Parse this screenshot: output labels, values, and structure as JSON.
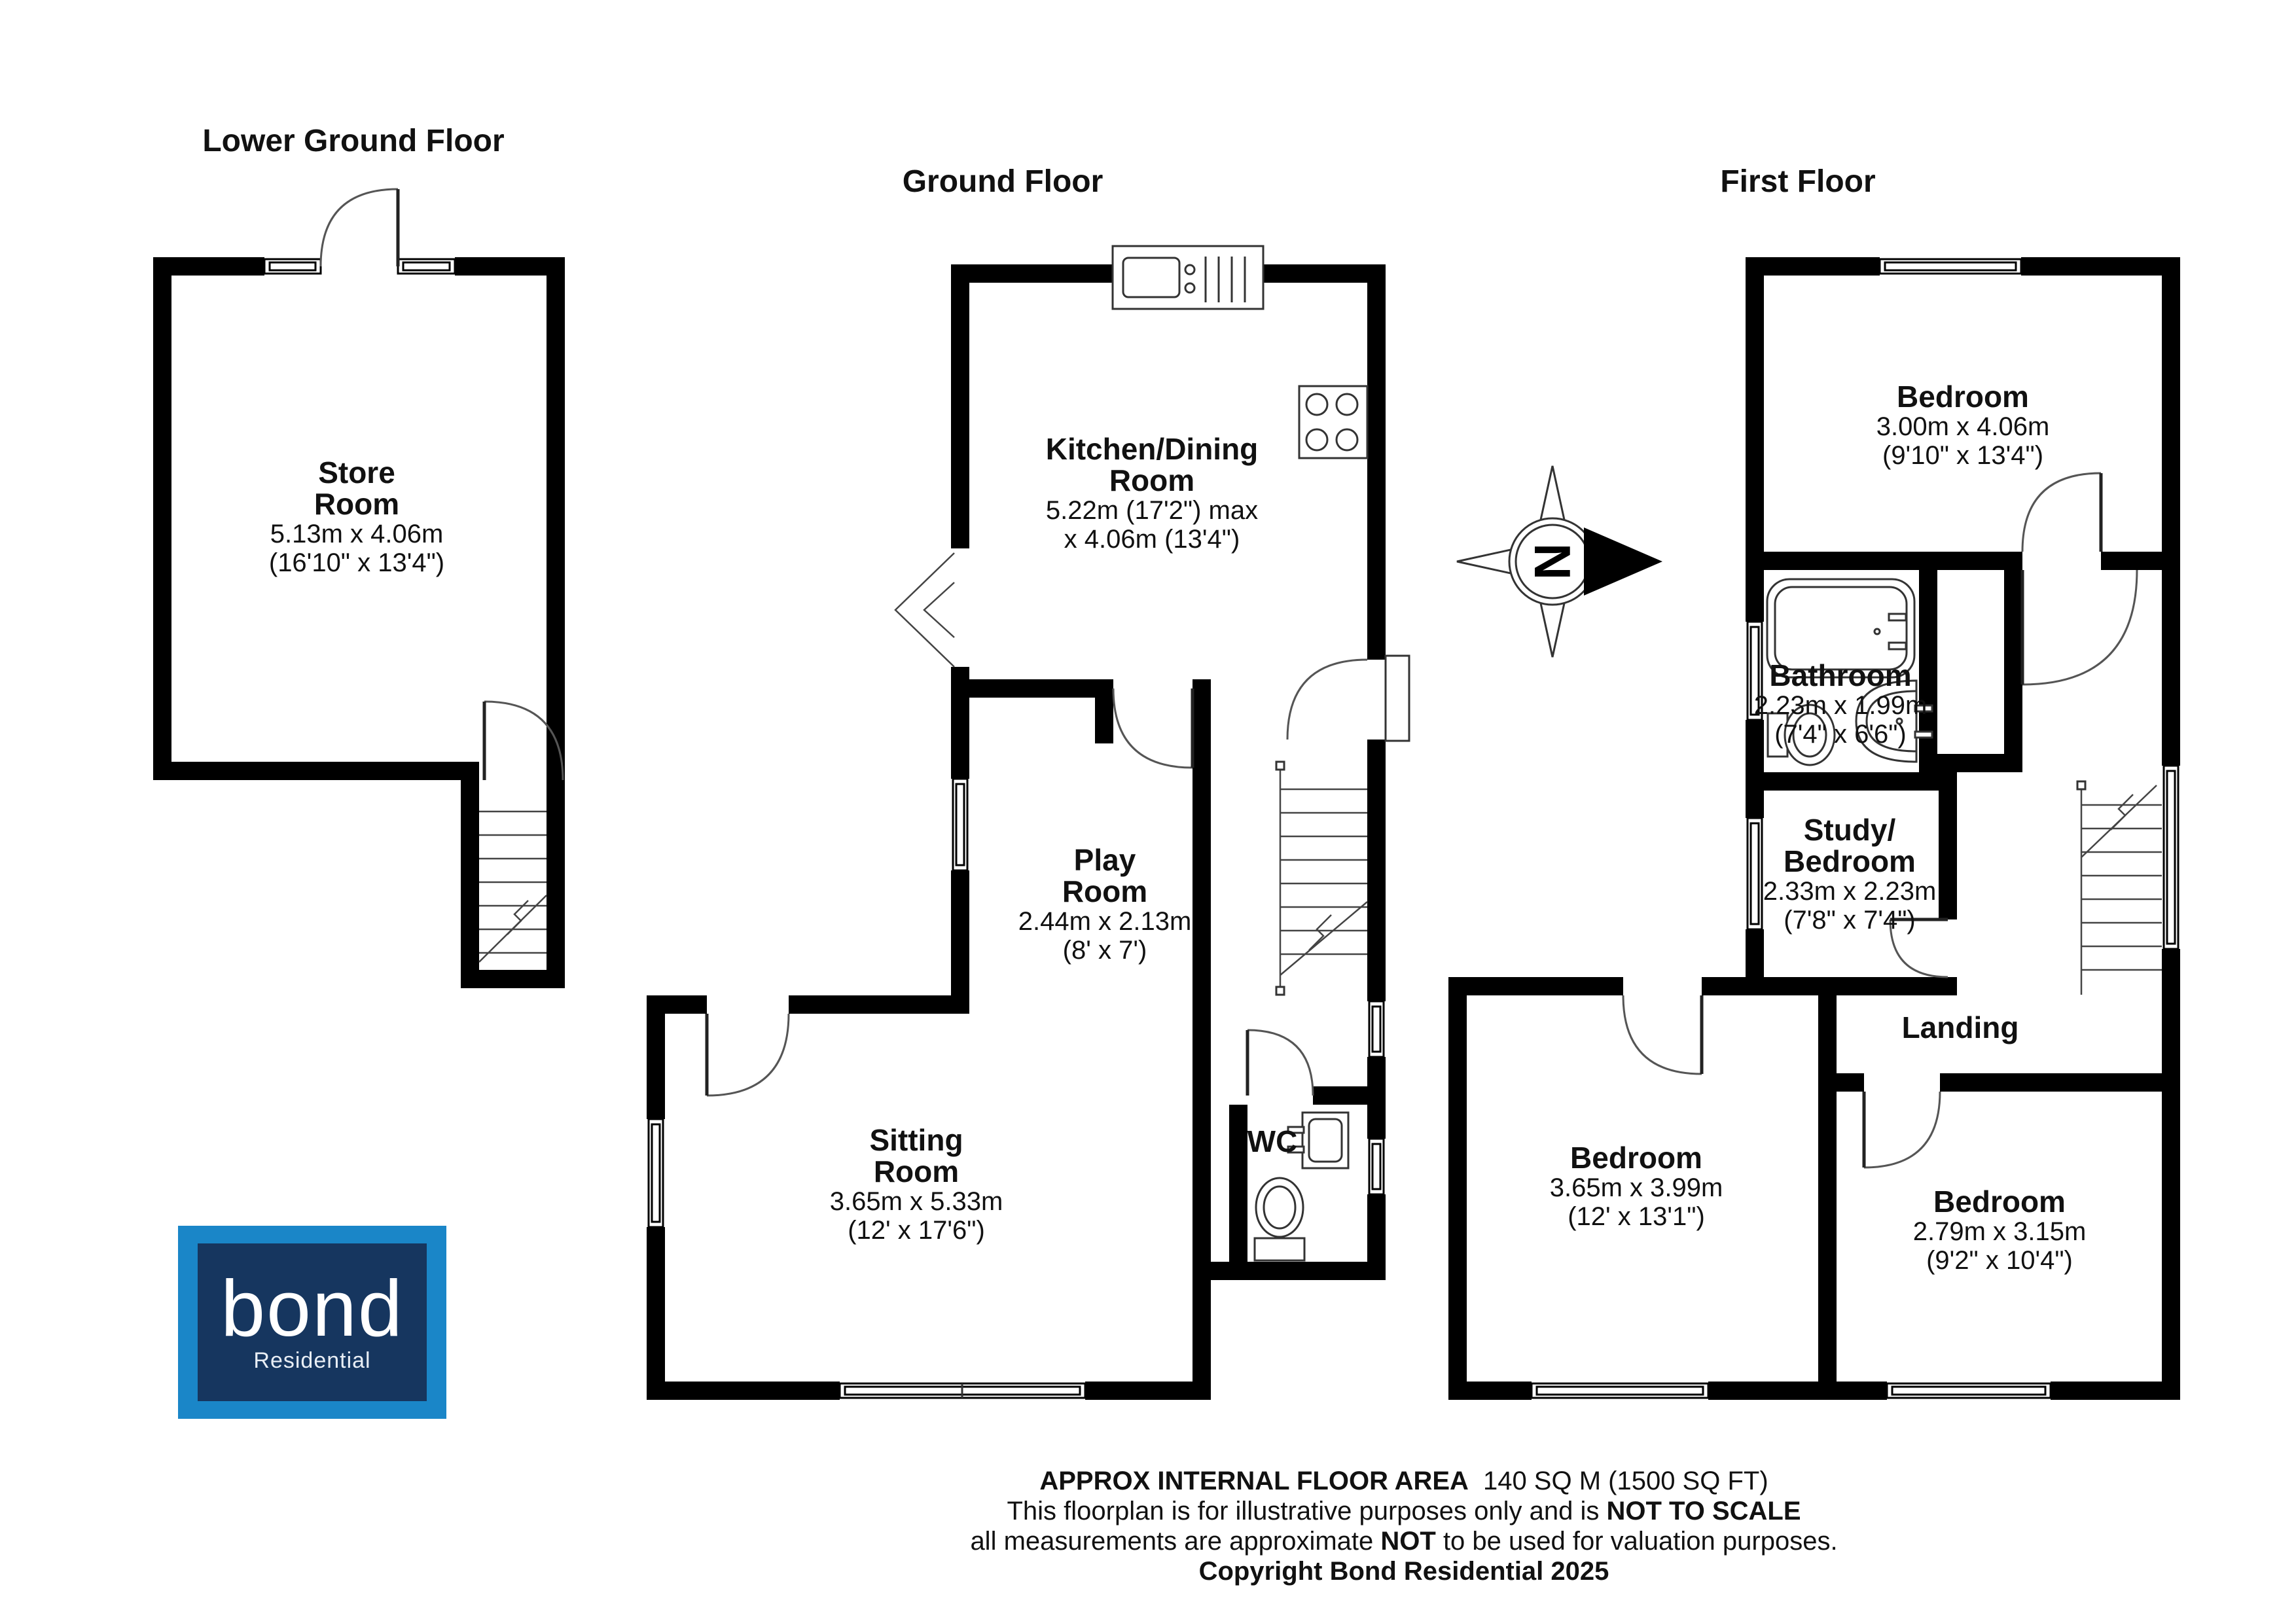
{
  "titles": {
    "lower": "Lower Ground Floor",
    "ground": "Ground Floor",
    "first": "First Floor"
  },
  "compass": {
    "letter": "N"
  },
  "rooms": {
    "store": {
      "line1": "Store",
      "line2": "Room",
      "dims1": "5.13m x 4.06m",
      "dims2": "(16'10\" x 13'4\")"
    },
    "kitchen": {
      "line1": "Kitchen/Dining",
      "line2": "Room",
      "dims1": "5.22m (17'2\") max",
      "dims2": "x 4.06m (13'4\")"
    },
    "play": {
      "line1": "Play",
      "line2": "Room",
      "dims1": "2.44m x 2.13m",
      "dims2": "(8' x 7')"
    },
    "sitting": {
      "line1": "Sitting",
      "line2": "Room",
      "dims1": "3.65m x 5.33m",
      "dims2": "(12' x 17'6\")"
    },
    "wc": {
      "line1": "WC"
    },
    "bedroom1": {
      "line1": "Bedroom",
      "dims1": "3.00m x 4.06m",
      "dims2": "(9'10\" x 13'4\")"
    },
    "bathroom": {
      "line1": "Bathroom",
      "dims1": "2.23m x 1.99m",
      "dims2": "(7'4\" x 6'6\")"
    },
    "study": {
      "line1": "Study/",
      "line2": "Bedroom",
      "dims1": "2.33m x 2.23m",
      "dims2": "(7'8\" x 7'4\")"
    },
    "landing": {
      "line1": "Landing"
    },
    "bedroom2": {
      "line1": "Bedroom",
      "dims1": "3.65m x 3.99m",
      "dims2": "(12' x 13'1\")"
    },
    "bedroom3": {
      "line1": "Bedroom",
      "dims1": "2.79m x 3.15m",
      "dims2": "(9'2\" x 10'4\")"
    }
  },
  "footer": {
    "line1_bold": "APPROX INTERNAL FLOOR AREA",
    "line1_rest": "140 SQ M (1500 SQ FT)",
    "line2_pre": "This floorplan is for illustrative purposes only and is ",
    "line2_bold": "NOT TO SCALE",
    "line3_pre": "all measurements are approximate ",
    "line3_bold": "NOT",
    "line3_post": " to be used for valuation purposes.",
    "line4": "Copyright Bond Residential 2025"
  },
  "logo": {
    "brand": "bond",
    "sub": "Residential",
    "outer_color": "#1a86c8",
    "inner_color": "#16365f"
  }
}
